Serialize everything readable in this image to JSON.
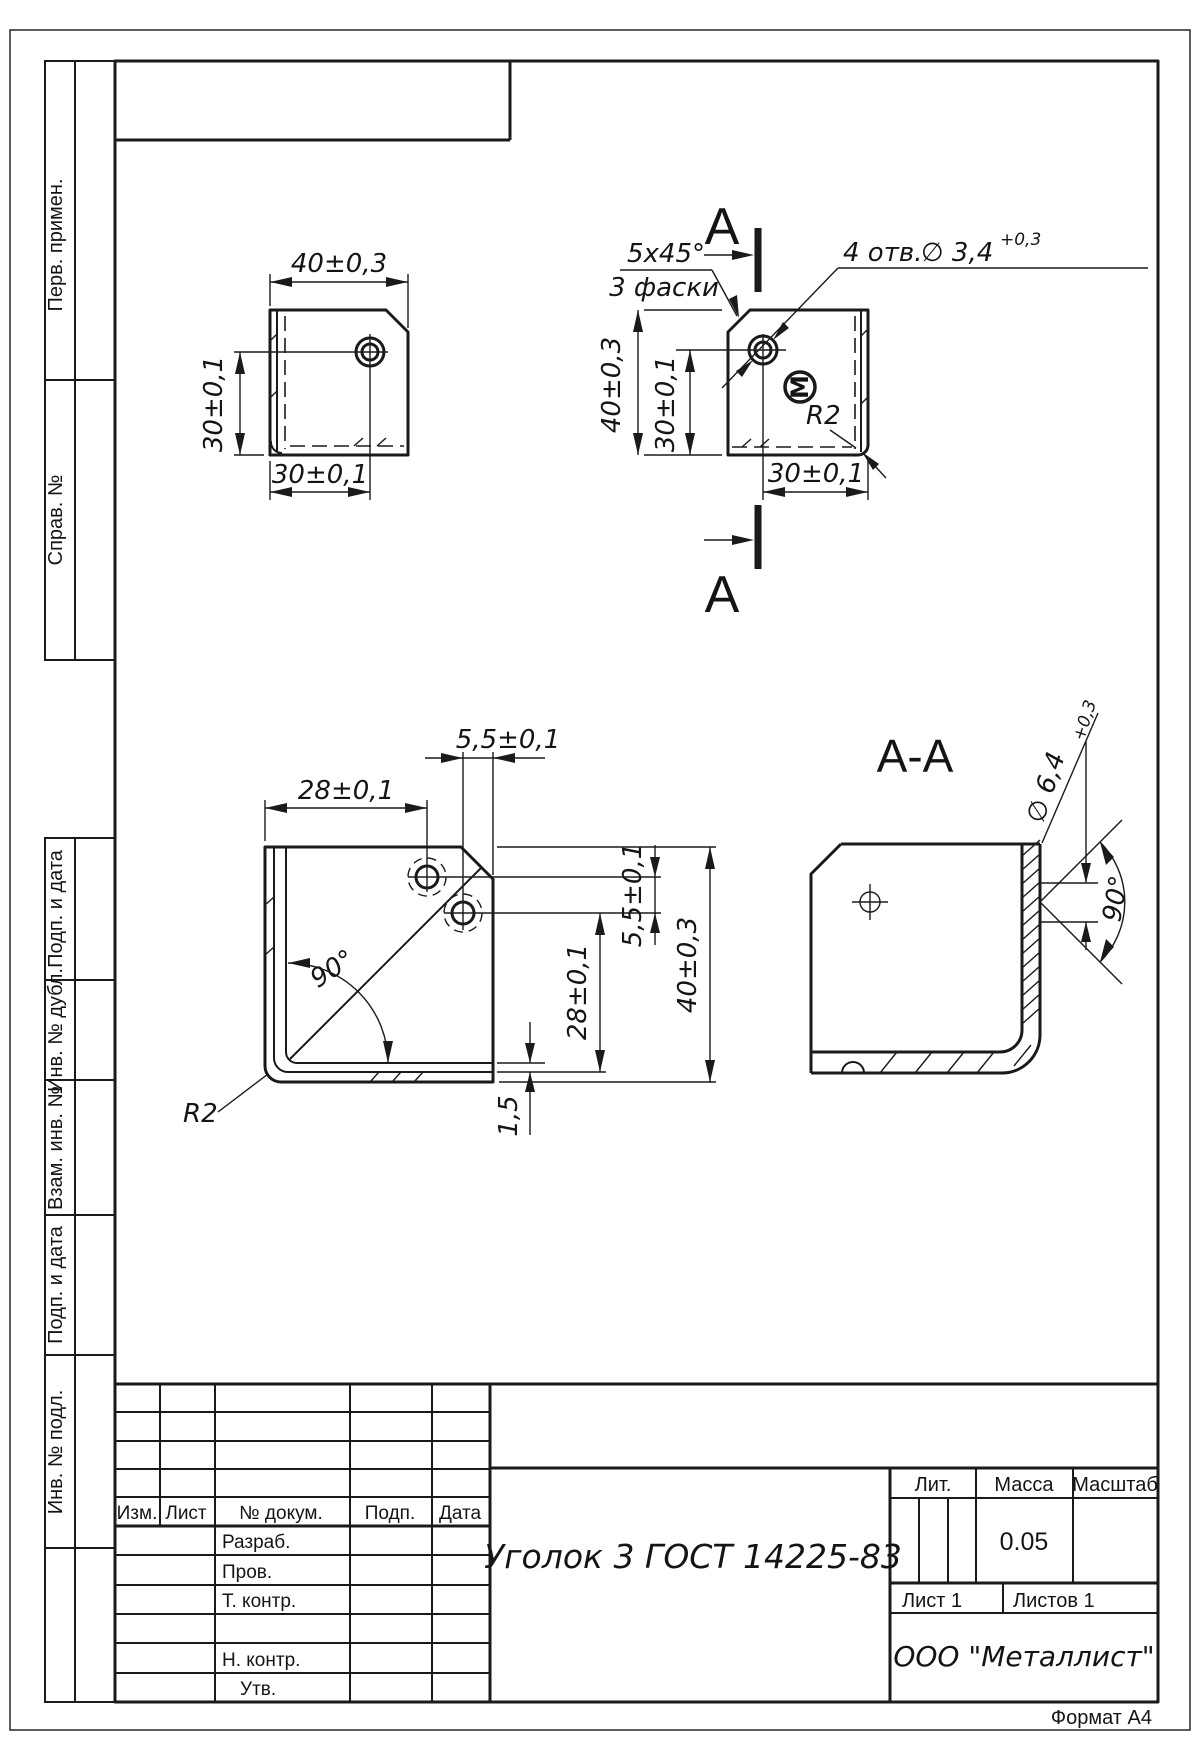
{
  "margin_labels": {
    "perv_primen": "Перв. примен.",
    "sprav_no": "Справ. №",
    "podp_i_data_1": "Подп. и дата",
    "inv_no_dubl": "Инв. № дубл.",
    "vzam_inv_no": "Взам. инв. №",
    "podp_i_data_2": "Подп. и дата",
    "inv_no_podl": "Инв. № подл."
  },
  "views": {
    "top_left": {
      "dim_width": "40±0,3",
      "dim_height": "30±0,1",
      "dim_bottom": "30±0,1"
    },
    "top_right": {
      "section_letter_top": "А",
      "section_letter_bottom": "А",
      "chamfer_dim": "5x45°",
      "chamfer_note": "3 фаски",
      "holes_count": "4 отв.",
      "holes_dia": "∅ 3,4",
      "holes_tol": "+0,3",
      "dim_height": "40±0,3",
      "dim_hole_v": "30±0,1",
      "dim_hole_h": "30±0,1",
      "radius": "R2",
      "mark_symbol": "М"
    },
    "bottom_left": {
      "dim_top": "28±0,1",
      "dim_top_small": "5,5±0,1",
      "bend_angle": "90°",
      "radius": "R2",
      "dim_right_28": "28±0,1",
      "dim_right_55": "5,5±0,1",
      "dim_right_40": "40±0,3",
      "thickness": "1,5"
    },
    "section": {
      "title": "А-А",
      "countersink_dia": "∅ 6,4",
      "countersink_tol": "+0,3",
      "countersink_angle": "90°"
    }
  },
  "title_block": {
    "rev_cols": {
      "izm": "Изм.",
      "list": "Лист",
      "n_dokum": "№ докум.",
      "podp": "Подп.",
      "data": "Дата"
    },
    "sig_rows": {
      "razrab": "Разраб.",
      "prov": "Пров.",
      "t_kontr": "Т. контр.",
      "n_kontr": "Н. контр.",
      "utv": "Утв."
    },
    "designation": "Уголок 3 ГОСТ 14225-83",
    "lit_label": "Лит.",
    "mass_label": "Масса",
    "scale_label": "Масштаб",
    "mass_value": "0.05",
    "sheet_label": "Лист 1",
    "sheets_label": "Листов 1",
    "company": "ООО \"Металлист\"",
    "format_label": "Формат А4"
  }
}
